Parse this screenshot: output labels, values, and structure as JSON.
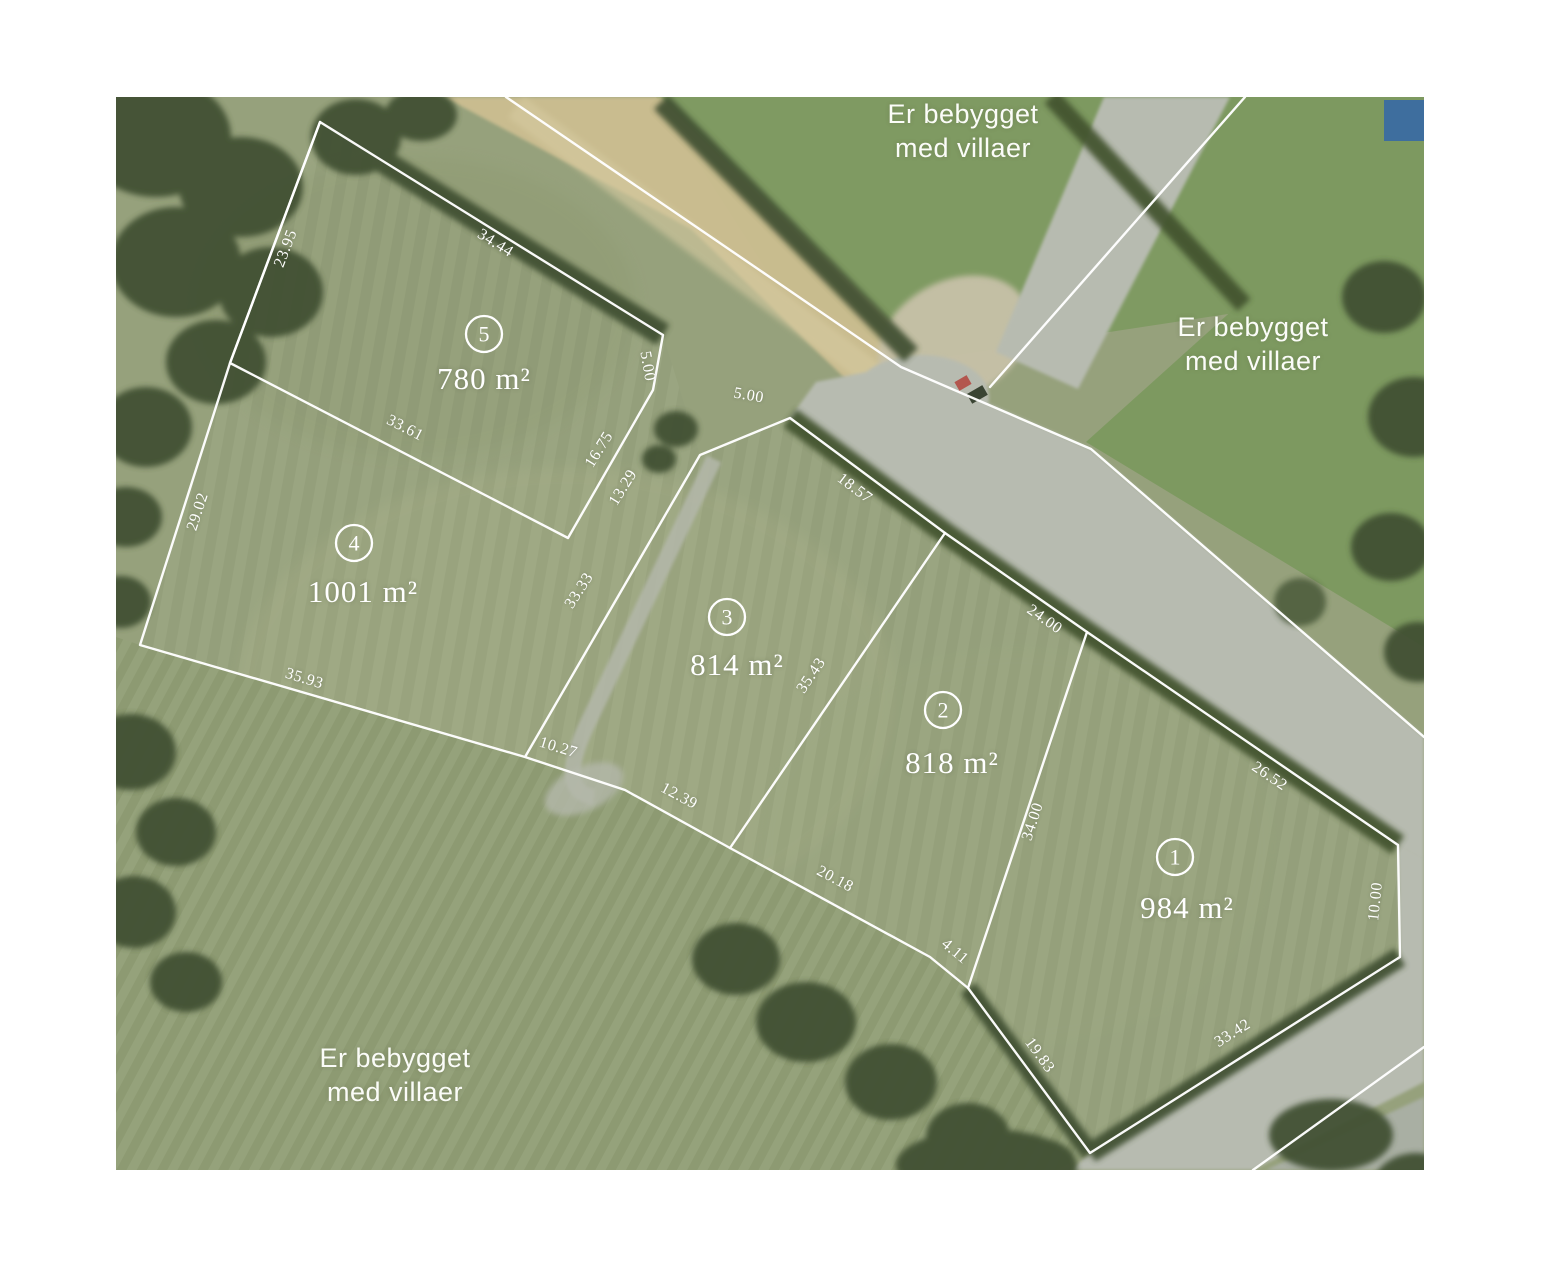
{
  "map": {
    "description": "Udstykningsplan / parcel map over aerial photo",
    "line_color": "#ffffff",
    "corner_marker_color": "#3e6e9e",
    "notes": [
      {
        "id": "note-top",
        "lines": [
          "Er bebygget",
          "med villaer"
        ],
        "x": 847,
        "y": 26
      },
      {
        "id": "note-right",
        "lines": [
          "Er bebygget",
          "med villaer"
        ],
        "x": 1137,
        "y": 239
      },
      {
        "id": "note-bottom-left",
        "lines": [
          "Er bebygget",
          "med villaer"
        ],
        "x": 279,
        "y": 970
      }
    ],
    "parcels": [
      {
        "number": "1",
        "area": "984 m²",
        "cx": 1059,
        "cy": 760,
        "lx": 1071,
        "ly": 821
      },
      {
        "number": "2",
        "area": "818 m²",
        "cx": 827,
        "cy": 613,
        "lx": 836,
        "ly": 676
      },
      {
        "number": "3",
        "area": "814 m²",
        "cx": 611,
        "cy": 520,
        "lx": 621,
        "ly": 578
      },
      {
        "number": "4",
        "area": "1001 m²",
        "cx": 238,
        "cy": 446,
        "lx": 247,
        "ly": 505
      },
      {
        "number": "5",
        "area": "780 m²",
        "cx": 368,
        "cy": 237,
        "lx": 368,
        "ly": 292
      }
    ],
    "measurements": [
      {
        "value": "23.95",
        "x": 174,
        "y": 153,
        "rot": -69
      },
      {
        "value": "34.44",
        "x": 377,
        "y": 150,
        "rot": 32
      },
      {
        "value": "33.61",
        "x": 287,
        "y": 335,
        "rot": 27
      },
      {
        "value": "29.02",
        "x": 86,
        "y": 416,
        "rot": -72
      },
      {
        "value": "5.00",
        "x": 527,
        "y": 270,
        "rot": 80
      },
      {
        "value": "5.00",
        "x": 632,
        "y": 303,
        "rot": 10
      },
      {
        "value": "16.75",
        "x": 487,
        "y": 355,
        "rot": -58
      },
      {
        "value": "13.29",
        "x": 511,
        "y": 393,
        "rot": -58
      },
      {
        "value": "33.33",
        "x": 467,
        "y": 496,
        "rot": -57
      },
      {
        "value": "18.57",
        "x": 736,
        "y": 395,
        "rot": 37
      },
      {
        "value": "24.00",
        "x": 926,
        "y": 526,
        "rot": 35
      },
      {
        "value": "35.43",
        "x": 699,
        "y": 581,
        "rot": -56
      },
      {
        "value": "34.00",
        "x": 921,
        "y": 726,
        "rot": -72
      },
      {
        "value": "35.93",
        "x": 187,
        "y": 586,
        "rot": 17
      },
      {
        "value": "10.27",
        "x": 441,
        "y": 655,
        "rot": 17
      },
      {
        "value": "12.39",
        "x": 561,
        "y": 703,
        "rot": 28
      },
      {
        "value": "20.18",
        "x": 717,
        "y": 786,
        "rot": 28
      },
      {
        "value": "4.11",
        "x": 836,
        "y": 858,
        "rot": 40
      },
      {
        "value": "19.83",
        "x": 920,
        "y": 961,
        "rot": 54
      },
      {
        "value": "33.42",
        "x": 1119,
        "y": 940,
        "rot": -32
      },
      {
        "value": "26.52",
        "x": 1151,
        "y": 683,
        "rot": 34
      },
      {
        "value": "10.00",
        "x": 1264,
        "y": 805,
        "rot": -84
      }
    ]
  }
}
